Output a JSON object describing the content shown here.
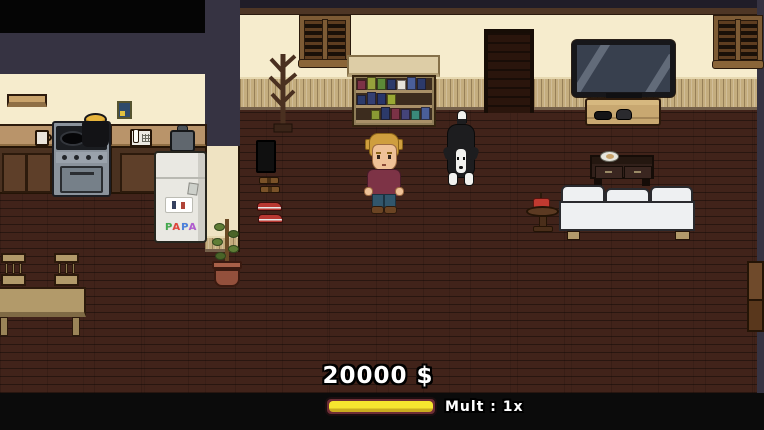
{
  "game": {
    "hud": {
      "money": "20000 $",
      "mult": "Mult : 1x",
      "progress_percent": 100,
      "bar_frame_color": "#6e2d35",
      "bar_track_color": "#b5342a",
      "bar_fill_color": "#f6e52f"
    },
    "fridge_art": {
      "letters": [
        {
          "char": "P",
          "color": "#44a94e"
        },
        {
          "char": "A",
          "color": "#e0453a"
        },
        {
          "char": "P",
          "color": "#4a7fdc"
        },
        {
          "char": "A",
          "color": "#b05ad0"
        }
      ]
    },
    "bookshelf": {
      "top_shelf": [
        "#7c3246",
        "#96a23c",
        "#5c8a38",
        "#2c3a6a",
        "#e8e4da",
        "#4a5f9a",
        "#2c3a6a"
      ],
      "middle_shelf": [
        "#2c3a6a",
        "#343f72",
        "#28356a",
        "#9aa834"
      ],
      "bottom_shelf": [
        "#8a9a34",
        "#2c3a6a",
        "#7c3246",
        "#44447a",
        "#3a8a7a",
        "#4a5f9a"
      ]
    },
    "palette": {
      "floor": "#41231a",
      "wall_cream": "#f6eccd",
      "wall_navy": "#363342",
      "wainscot": "#c4ad7e",
      "top_trim": "#4e3625",
      "player_sweater": "#7d3346",
      "player_hair": "#cf9e3e",
      "dog_black": "#1d1d1f",
      "dog_white": "#f2f2ef"
    }
  }
}
